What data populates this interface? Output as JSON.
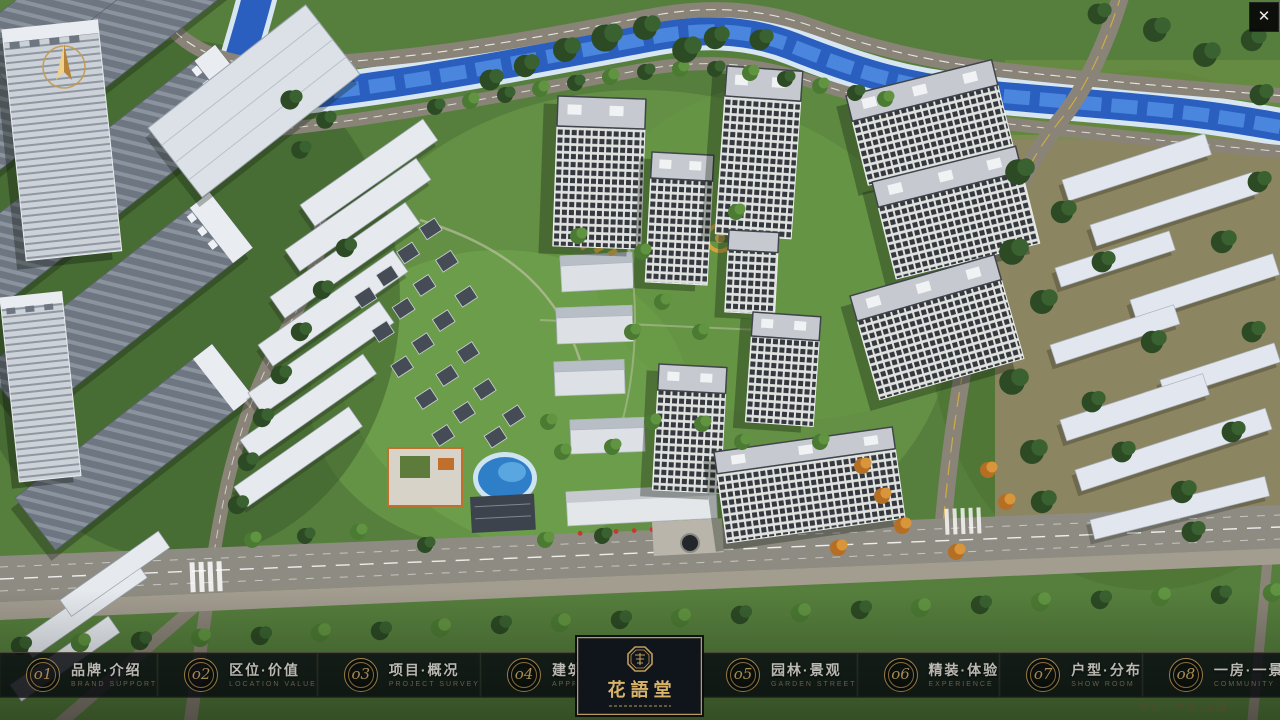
{
  "window": {
    "close_glyph": "✕"
  },
  "project": {
    "logo_zh": "花語堂",
    "address": "地址：中国·山西"
  },
  "icons": {
    "compass": "compass-north-arrow",
    "seal": "brand-seal-emblem"
  },
  "colors": {
    "gold_accent": "#c9a55e",
    "bar_background": "rgba(10,14,19,0.82)",
    "river_blue": "#2a5fc0"
  },
  "navbar": {
    "items": [
      {
        "num": "o1",
        "zh": "品牌·介绍",
        "en": "BRAND SUPPORT"
      },
      {
        "num": "o2",
        "zh": "区位·价值",
        "en": "LOCATION VALUE"
      },
      {
        "num": "o3",
        "zh": "项目·概况",
        "en": "PROJECT SURVEY"
      },
      {
        "num": "o4",
        "zh": "建筑·鉴赏",
        "en": "APPRECIATION"
      },
      {
        "num": "o5",
        "zh": "园林·景观",
        "en": "GARDEN STREET"
      },
      {
        "num": "o6",
        "zh": "精装·体验",
        "en": "EXPERIENCE"
      },
      {
        "num": "o7",
        "zh": "户型·分布",
        "en": "SHOW ROOM"
      },
      {
        "num": "o8",
        "zh": "一房·一景",
        "en": "COMMUNITY"
      }
    ]
  }
}
